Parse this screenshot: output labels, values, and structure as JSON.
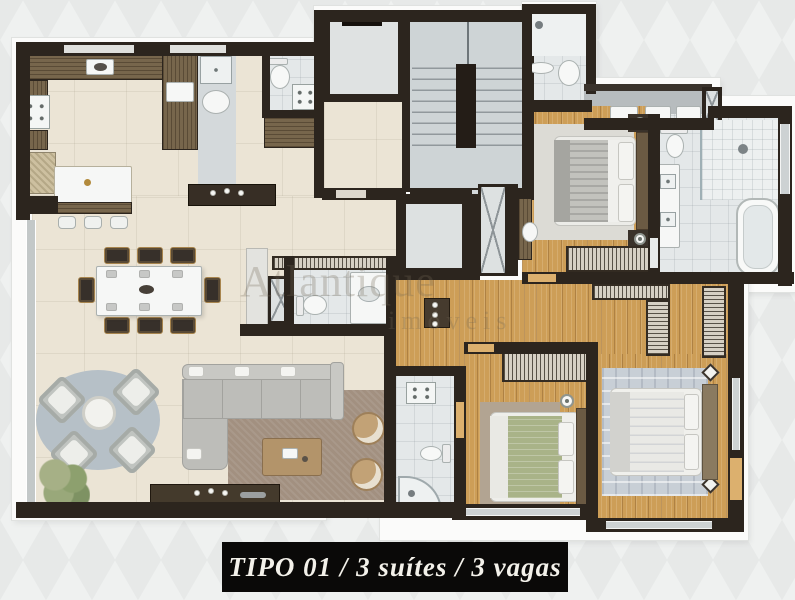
{
  "caption": {
    "text": "TIPO 01 / 3 suítes / 3 vagas"
  },
  "watermark": {
    "line1": "Atlantique",
    "line2": "imóveis"
  },
  "palette": {
    "page_background": "#eff1f0",
    "walls": "#2c251e",
    "floor_living_cream": "#ebe4d5",
    "floor_wood": "#cd9e57",
    "floor_bathroom": "#e4e8e9",
    "floor_common_grey": "#d4d9db",
    "cabinet_wood": "#77664c",
    "sofa_grey": "#c3c3c0",
    "rug_living": "#a29080",
    "rug_terrace": "#b6c0c7",
    "bed_green": "#a9b388",
    "caption_background": "#0a0908",
    "caption_text": "#f3f1ea"
  }
}
